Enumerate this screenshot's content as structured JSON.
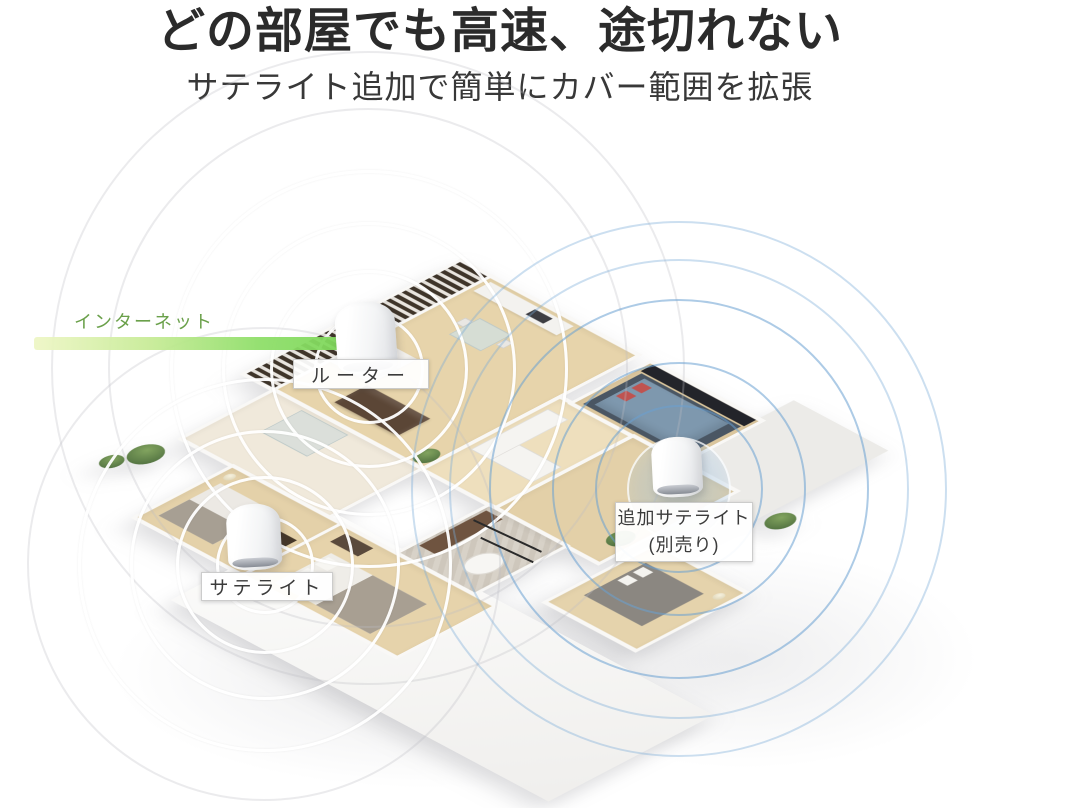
{
  "header": {
    "title": "どの部屋でも高速、途切れない",
    "subtitle": "サテライト追加で簡単にカバー範囲を拡張"
  },
  "annotations": {
    "internet_label": "インターネット",
    "router_label": "ルーター",
    "satellite_label": "サテライト",
    "additional_satellite_line1": "追加サテライト",
    "additional_satellite_line2": "(別売り)"
  },
  "colors": {
    "title_text": "#2b2b2b",
    "subtitle_text": "#383838",
    "internet_green": "#6aa04a",
    "internet_bar_start": "#eef6c6",
    "internet_bar_end": "#79d556",
    "coverage_white": "#ffffff",
    "coverage_blue": "#6ca2d4",
    "label_text": "#3b3b3b",
    "label_bg": "#ffffff"
  }
}
